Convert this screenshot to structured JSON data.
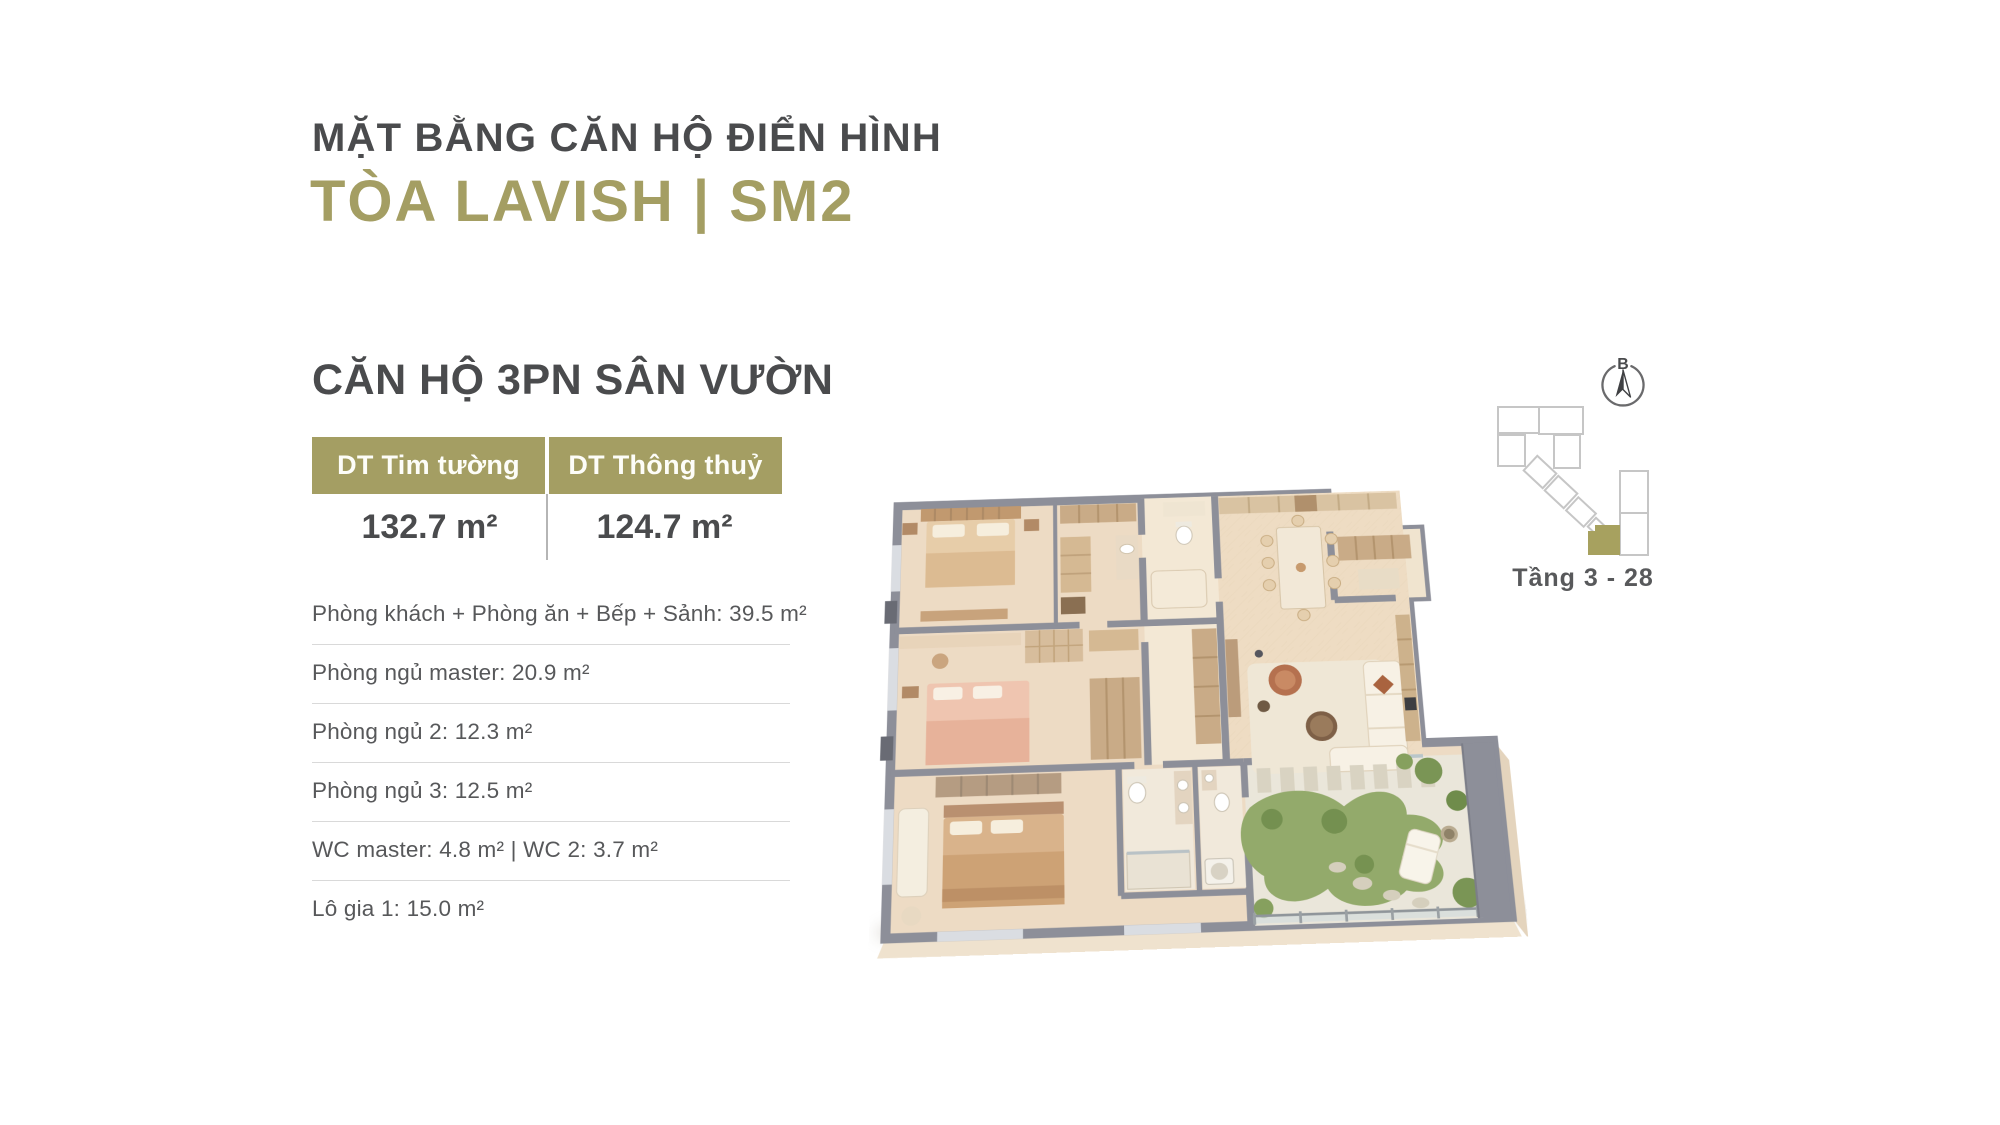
{
  "header": {
    "title": "MẶT BẰNG CĂN HỘ ĐIỂN HÌNH",
    "building": "TÒA LAVISH | SM2"
  },
  "unit": {
    "name": "CĂN HỘ 3PN SÂN VƯỜN",
    "area_table": {
      "columns": [
        {
          "label": "DT Tim tường",
          "value": "132.7 m²"
        },
        {
          "label": "DT Thông thuỷ",
          "value": "124.7 m²"
        }
      ]
    },
    "rooms": [
      "Phòng khách + Phòng ăn + Bếp + Sảnh: 39.5 m²",
      "Phòng ngủ master: 20.9 m²",
      "Phòng ngủ 2: 12.3 m²",
      "Phòng ngủ 3: 12.5 m²",
      "WC master: 4.8 m² | WC 2: 3.7 m²",
      "Lô gia 1: 15.0 m²"
    ]
  },
  "locator": {
    "compass_label": "B",
    "caption": "Tầng 3 - 28"
  },
  "colors": {
    "accent_olive": "#a49e63",
    "heading_dark": "#4a4b4d",
    "body_text": "#57585a",
    "wall_gray": "#8d8f99",
    "floor_beige": "#eddbc4",
    "garden_green": "#93aa6b"
  }
}
